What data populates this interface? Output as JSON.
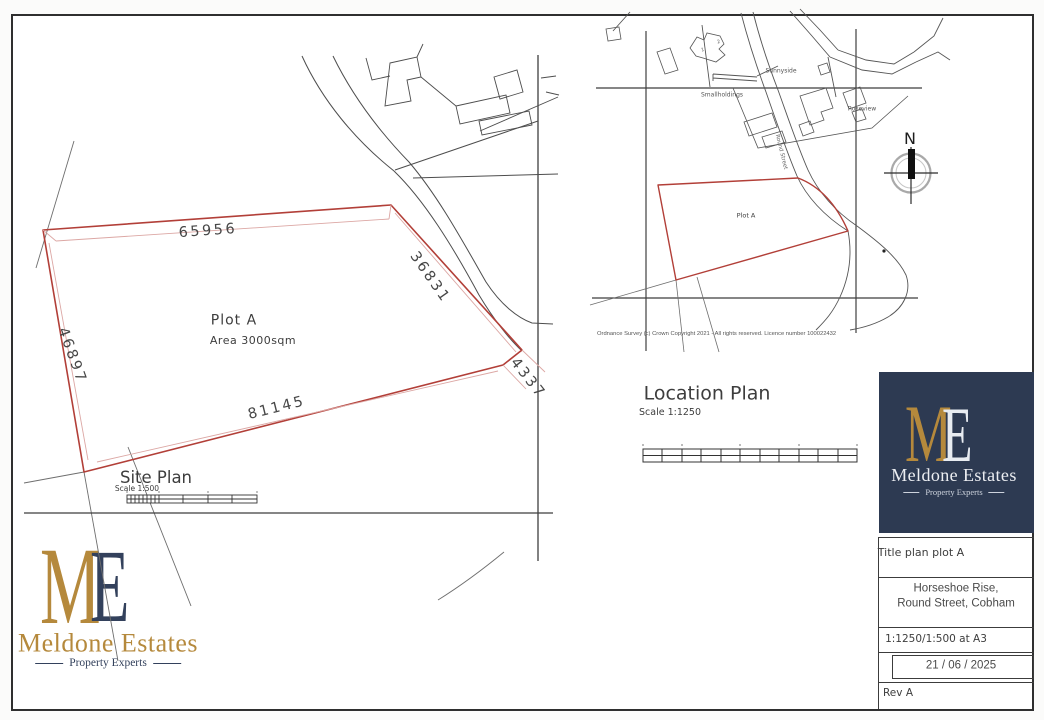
{
  "brand": {
    "monogram_m": "M",
    "monogram_e": "E",
    "name": "Meldone Estates",
    "tagline": "Property Experts"
  },
  "site_plan": {
    "title": "Site Plan",
    "scale_label": "Scale 1:500",
    "plot_label": "Plot A",
    "area_label": "Area 3000sqm",
    "dimensions": {
      "top": "65956",
      "right": "36831",
      "left": "46897",
      "bottom": "81145",
      "corner": "4337"
    }
  },
  "location_plan": {
    "title": "Location Plan",
    "scale_label": "Scale 1:1250",
    "plot_label": "Plot A",
    "north_label": "N",
    "street_label": "Round Street",
    "place_labels": {
      "sunnyside": "Sunnyside",
      "smallholdings": "Smallholdings",
      "roseview": "Roseview",
      "house_no_1": "1",
      "house_no_2": "2"
    },
    "copyright": "Ordnance Survey (c) Crown Copyright 2021 - All rights reserved. Licence number 100022432"
  },
  "title_block": {
    "title": "Title plan plot A",
    "address_line1": "Horseshoe Rise,",
    "address_line2": "Round Street, Cobham",
    "scale": "1:1250/1:500 at A3",
    "date": "21 / 06 / 2025",
    "revision": "Rev A"
  },
  "colors": {
    "plot_red": "#b23f38",
    "dim_pink": "#dca7a4",
    "line_gray": "#4d4d4d",
    "navy": "#2d3a52",
    "gold": "#b5893c"
  }
}
